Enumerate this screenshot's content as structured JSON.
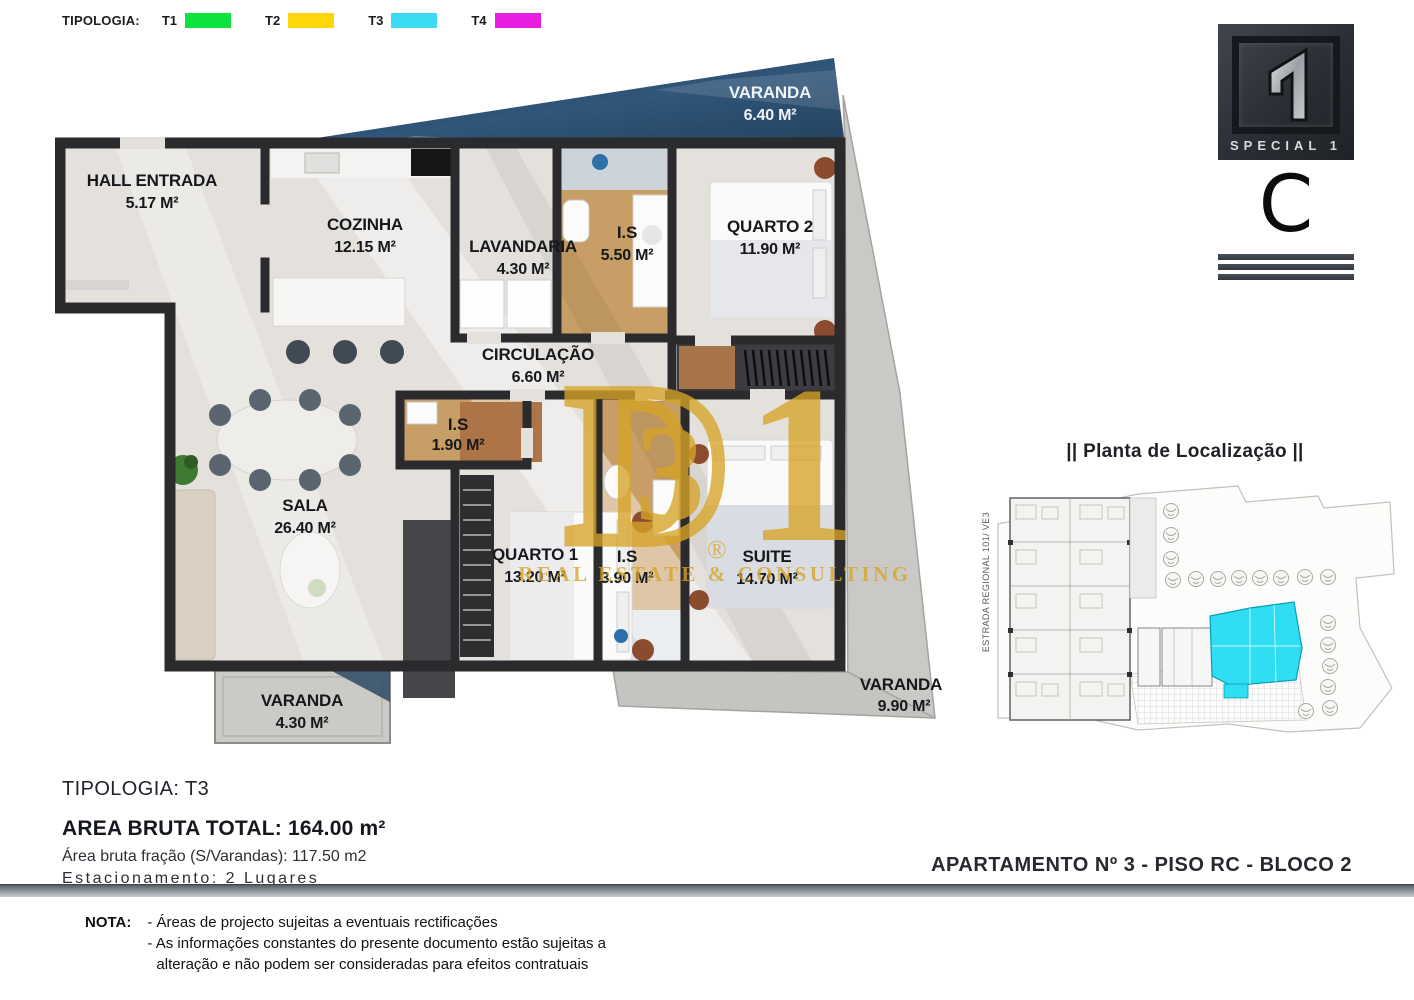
{
  "legend": {
    "title": "TIPOLOGIA:",
    "items": [
      {
        "label": "T1",
        "color": "#0ce23c"
      },
      {
        "label": "T2",
        "color": "#ffd60a"
      },
      {
        "label": "T3",
        "color": "#3bdcf2"
      },
      {
        "label": "T4",
        "color": "#e81fe0"
      }
    ]
  },
  "logo": {
    "brand": "SPECIAL 1",
    "unit_letter": "C"
  },
  "floor_plan": {
    "rooms": {
      "hall": {
        "name": "HALL ENTRADA",
        "area": "5.17 M²"
      },
      "cozinha": {
        "name": "COZINHA",
        "area": "12.15 M²"
      },
      "lavandaria": {
        "name": "LAVANDARIA",
        "area": "4.30 M²"
      },
      "is_550": {
        "name": "I.S",
        "area": "5.50 M²"
      },
      "quarto2": {
        "name": "QUARTO 2",
        "area": "11.90 M²"
      },
      "varanda_top": {
        "name": "VARANDA",
        "area": "6.40 M²"
      },
      "circulacao": {
        "name": "CIRCULAÇÃO",
        "area": "6.60 M²"
      },
      "is_190": {
        "name": "I.S",
        "area": "1.90 M²"
      },
      "sala": {
        "name": "SALA",
        "area": "26.40 M²"
      },
      "quarto1": {
        "name": "QUARTO 1",
        "area": "13.20 M²"
      },
      "is_390": {
        "name": "I.S",
        "area": "3.90 M²"
      },
      "suite": {
        "name": "SUITE",
        "area": "14.70 M²"
      },
      "varanda_sw": {
        "name": "VARANDA",
        "area": "4.30 M²"
      },
      "varanda_e": {
        "name": "VARANDA",
        "area": "9.90 M²"
      }
    },
    "watermark": {
      "monogram_d": "D",
      "monogram_3": "3",
      "monogram_1": "1",
      "registered": "®",
      "text": "REAL ESTATE & CONSULTING",
      "color": "#d7a427"
    }
  },
  "location_plan": {
    "title": "|| Planta de Localização ||",
    "road_label": "ESTRADA REGIONAL 101/ VE3",
    "highlight_color": "#2fdef2"
  },
  "summary": {
    "tipologia": "TIPOLOGIA: T3",
    "area_total": "AREA BRUTA TOTAL: 164.00 m²",
    "area_fracao": "Área bruta fração (S/Varandas): 117.50 m2",
    "estacionamento": "Estacionamento: 2 Lugares"
  },
  "footer": {
    "apartment": "APARTAMENTO Nº  3 - PISO RC - BLOCO 2",
    "nota_label": "NOTA:",
    "nota_lines": [
      "- Áreas de projecto sujeitas a eventuais rectificações",
      "- As informações constantes do presente documento estão sujeitas a",
      "alteração e não podem ser consideradas para efeitos contratuais"
    ]
  }
}
